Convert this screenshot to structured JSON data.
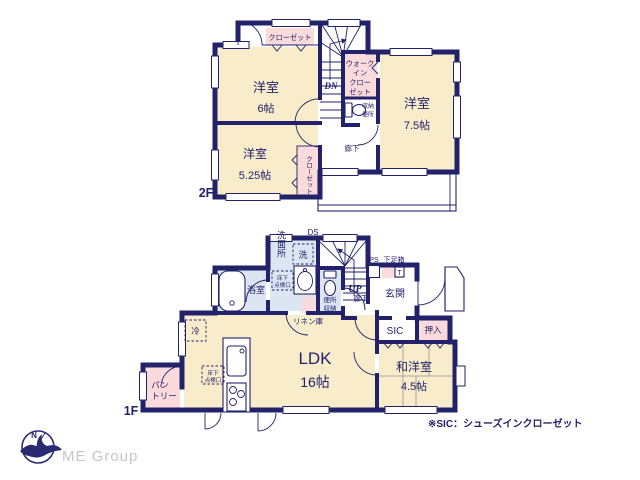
{
  "colors": {
    "wall_navy": "#22226b",
    "room_cream": "#f8eccb",
    "closet_pink": "#fadadb",
    "wet_blue": "#dce6f2",
    "brand_gray": "#c6c6c6"
  },
  "floor2": {
    "label": "2F",
    "stairs_down": "DN",
    "closet_north": "クローゼット",
    "room_nw": {
      "name": "洋室",
      "size": "6帖"
    },
    "room_sw": {
      "name": "洋室",
      "size": "5.25帖"
    },
    "room_e": {
      "name": "洋室",
      "size": "7.5帖"
    },
    "closet_sw": "クローゼット",
    "wic": {
      "line1": "ウォーク",
      "line2": "イン",
      "line3": "クロー",
      "line4": "ゼット"
    },
    "storage": "収納",
    "toilet": "便所",
    "hallway": "廊下"
  },
  "floor1": {
    "label": "1F",
    "stairs_up": "UP",
    "duct": "DS",
    "pipe": "PS",
    "washroom": "洗面所",
    "laundry": "洗",
    "bath": "浴室",
    "hatch_bath": {
      "line1": "床下",
      "line2": "点検口"
    },
    "toilet": "便所",
    "toilet_storage": "収納",
    "hallway": "廊下",
    "shoebox": "下足箱",
    "shoebox_t": "T",
    "entrance": "玄関",
    "sic": "SIC",
    "oshiire": "押入",
    "linen": "リネン庫",
    "fridge": "冷",
    "ldk": {
      "name": "LDK",
      "size": "16帖"
    },
    "hatch_ldk": {
      "line1": "床下",
      "line2": "点検口"
    },
    "pantry": {
      "line1": "パン",
      "line2": "トリー"
    },
    "washitsu": {
      "name": "和洋室",
      "size": "4.5帖"
    }
  },
  "footer": {
    "note": "※SIC：シューズインクローゼット",
    "brand": "ME Group",
    "compass_n": "N"
  }
}
